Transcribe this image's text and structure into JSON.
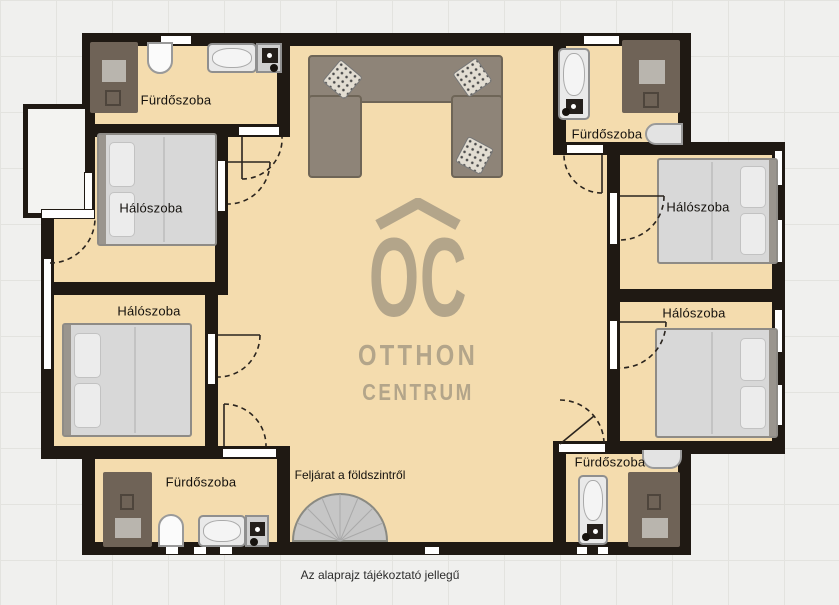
{
  "caption": "Az alaprajz tájékoztató jellegű",
  "logo": {
    "monogram": "OC",
    "line1": "OTTHON",
    "line2": "CENTRUM"
  },
  "rooms": {
    "bathroom_top_left": {
      "label": "Fürdőszoba"
    },
    "bedroom_left_top": {
      "label": "Hálószoba"
    },
    "bedroom_left_middle": {
      "label": "Hálószoba"
    },
    "bathroom_bottom_left": {
      "label": "Fürdőszoba"
    },
    "bathroom_top_right": {
      "label": "Fürdőszoba"
    },
    "bedroom_right_top": {
      "label": "Hálószoba"
    },
    "bedroom_right_bottom": {
      "label": "Hálószoba"
    },
    "bathroom_bottom_right": {
      "label": "Fürdőszoba"
    },
    "staircase": {
      "label": "Feljárat a földszintről"
    }
  },
  "colors": {
    "background": "#f0f0ee",
    "floor": "#f4dcae",
    "wall": "#1f1913",
    "logo": "#b3a58a"
  }
}
